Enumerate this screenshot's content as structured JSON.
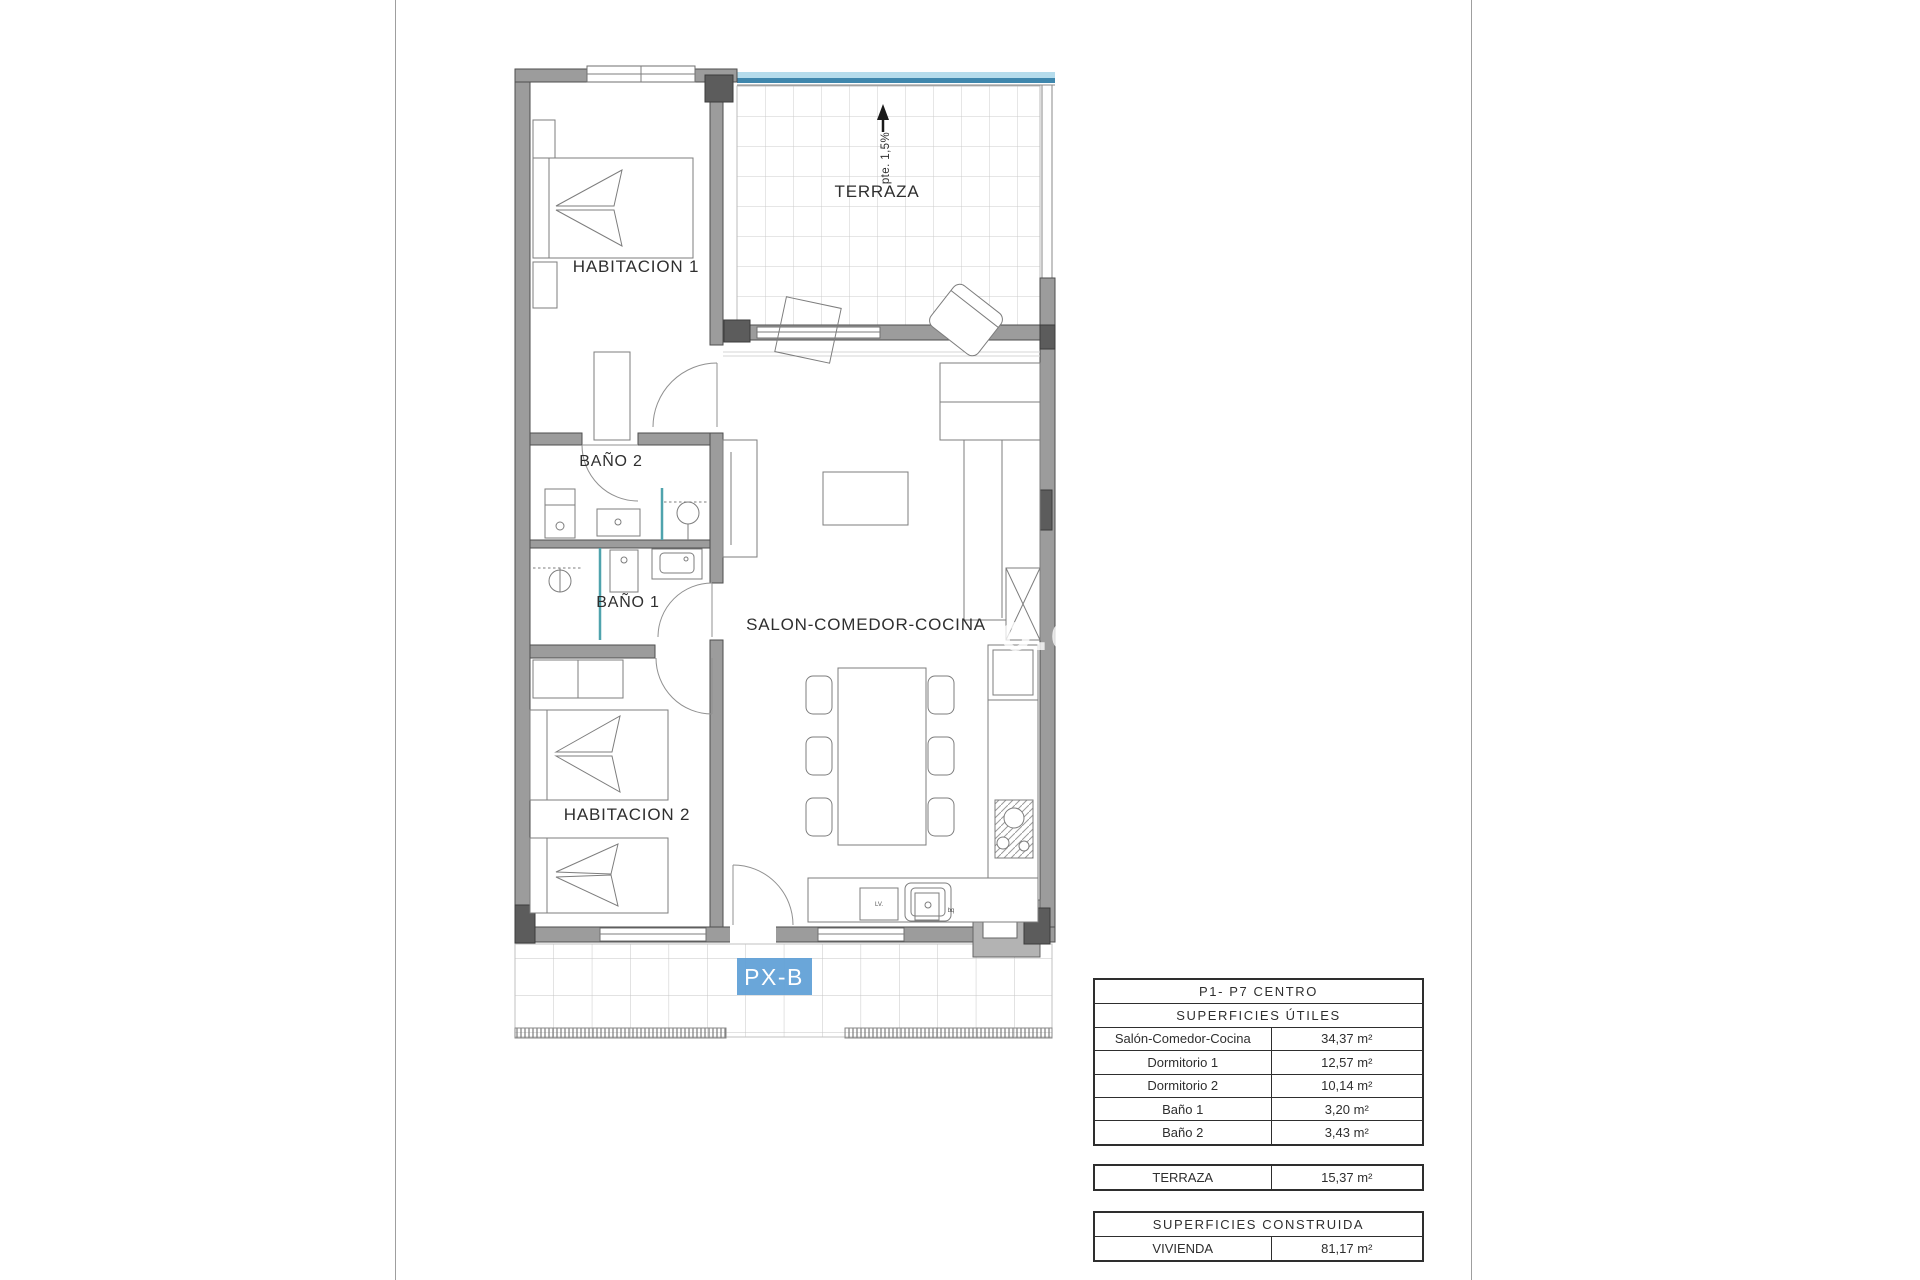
{
  "plan": {
    "labels": {
      "habitacion1": "HABITACION 1",
      "habitacion2": "HABITACION 2",
      "bano1": "BAÑO 1",
      "bano2": "BAÑO 2",
      "salon": "SALON-COMEDOR-COCINA",
      "terraza": "TERRAZA",
      "slope": "pte. 1,5%",
      "unit_tag": "PX-B",
      "appliance_left": "LV.",
      "appliance_right": "bq"
    },
    "watermark": "o.c",
    "colors": {
      "wall": "#9c9c9c",
      "wall_dark": "#5c5c5c",
      "terrace_edge_light": "#b5dcec",
      "terrace_edge_dark": "#3f87ad",
      "glass": "#4fa3ad",
      "tile_grid": "#cccccc",
      "unit_tag_bg": "#5d9ed6"
    }
  },
  "tables": {
    "main": {
      "title": "P1- P7 CENTRO",
      "subtitle": "SUPERFICIES ÚTILES",
      "rows": [
        {
          "name": "Salón-Comedor-Cocina",
          "value": "34,37 m²"
        },
        {
          "name": "Dormitorio 1",
          "value": "12,57 m²"
        },
        {
          "name": "Dormitorio 2",
          "value": "10,14 m²"
        },
        {
          "name": "Baño 1",
          "value": "3,20 m²"
        },
        {
          "name": "Baño 2",
          "value": "3,43 m²"
        }
      ]
    },
    "terraza": {
      "name": "TERRAZA",
      "value": "15,37 m²"
    },
    "construida": {
      "title": "SUPERFICIES CONSTRUIDA",
      "rows": [
        {
          "name": "VIVIENDA",
          "value": "81,17 m²"
        }
      ]
    }
  }
}
